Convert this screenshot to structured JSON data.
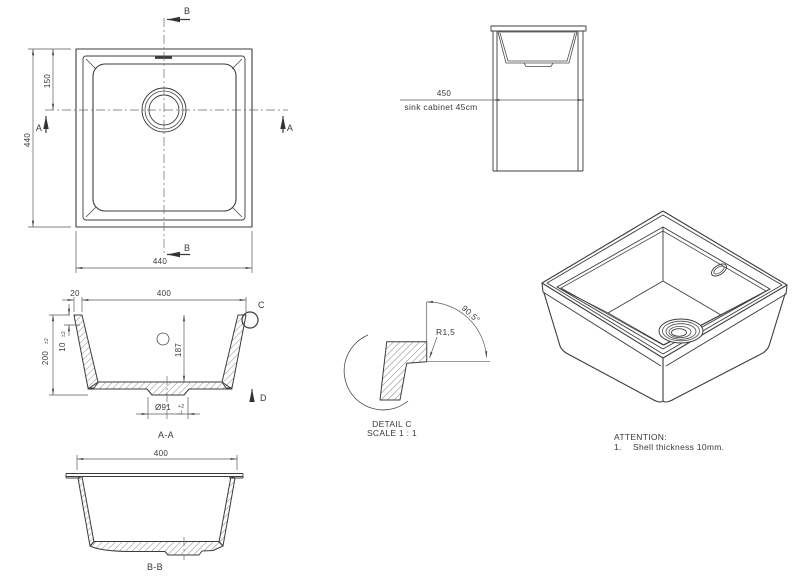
{
  "colors": {
    "line": "#3c3c3c",
    "dim": "#5a5a5a",
    "text": "#3a3a3a",
    "background": "#ffffff"
  },
  "plan_view": {
    "dim_height": "440",
    "dim_drain_offset": "150",
    "dim_width": "440",
    "marker_a_left": "A",
    "marker_a_right": "A",
    "marker_b_top": "B",
    "marker_b_bottom": "B"
  },
  "cabinet_view": {
    "dim_width": "450",
    "caption": "sink cabinet 45cm"
  },
  "section_aa": {
    "label": "A-A",
    "dim_flange": "20",
    "dim_inner_width": "400",
    "dim_height": "200",
    "dim_height_tol": "±2",
    "dim_shell": "10",
    "dim_shell_tol": "±2",
    "dim_inner_depth": "187",
    "dim_drain_dia": "Ø91",
    "dim_drain_tol_plus": "+2",
    "dim_drain_tol_minus": "-1",
    "detail_marker": "C",
    "arrow_marker": "D"
  },
  "detail_c": {
    "radius": "R1,5",
    "angle": "90.5°",
    "title": "DETAIL C",
    "scale": "SCALE 1 : 1"
  },
  "section_bb": {
    "label": "B-B",
    "dim_width": "400"
  },
  "notes": {
    "heading": "ATTENTION:",
    "item_number": "1.",
    "item_text": "Shell thickness 10mm."
  }
}
